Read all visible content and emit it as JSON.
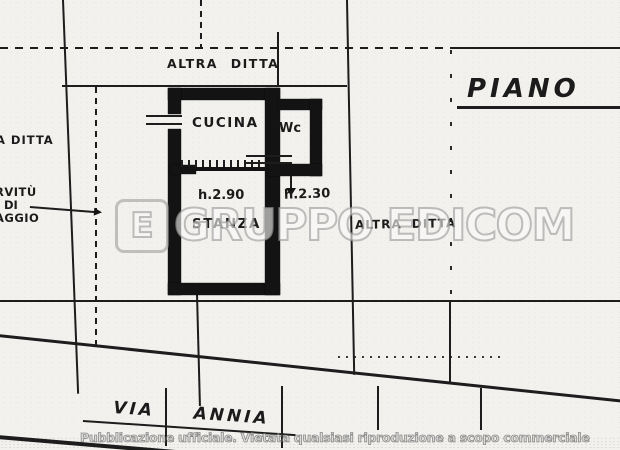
{
  "plan": {
    "floor_title": "PIANO T",
    "boundary_labels": {
      "top": "ALTRA DITTA",
      "right": "ALTRA DITTA",
      "left_partial": "A DITTA"
    },
    "easement_label": {
      "line1": "RVITÙ",
      "line2": "DI",
      "line3": "AGGIO"
    },
    "rooms": {
      "kitchen": "CUCINA",
      "wc": "Wc",
      "bedroom": "STANZA"
    },
    "heights": {
      "main": "h.2.90",
      "wc": "h.2.30"
    },
    "street_name": "VIA ANNIA"
  },
  "watermark": {
    "logo_letter": "E",
    "brand": "GRUPPO EDICOM"
  },
  "footer": {
    "notice": "Pubblicazione ufficiale. Vietata qualsiasi riproduzione a scopo commerciale"
  },
  "colors": {
    "ink": "#1a1a1a",
    "paper": "#f2f1ee",
    "watermark_gray": "#969696"
  }
}
